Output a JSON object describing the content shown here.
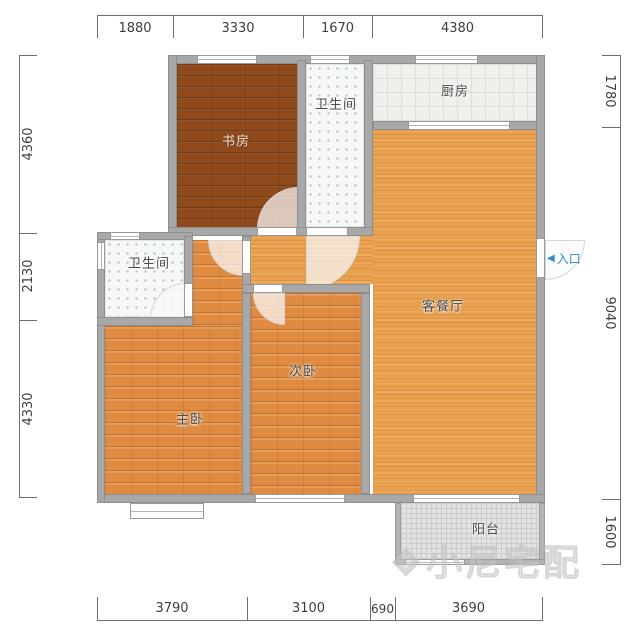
{
  "plan": {
    "rooms": [
      {
        "id": "study",
        "label": "书房"
      },
      {
        "id": "bathroom-top",
        "label": "卫生间"
      },
      {
        "id": "kitchen",
        "label": "厨房"
      },
      {
        "id": "living-dining",
        "label": "客餐厅"
      },
      {
        "id": "bathroom-2",
        "label": "卫生间"
      },
      {
        "id": "master-bedroom",
        "label": "主卧"
      },
      {
        "id": "second-bedroom",
        "label": "次卧"
      },
      {
        "id": "balcony",
        "label": "阳台"
      }
    ],
    "entrance": {
      "arrow": "◀",
      "label": "入口"
    },
    "watermark": {
      "logo": "◈",
      "text": "小尼宅配"
    }
  },
  "rulers": {
    "top": [
      "1880",
      "3330",
      "1670",
      "4380"
    ],
    "bottom": [
      "3790",
      "3100",
      "690",
      "3690"
    ],
    "left": [
      "4360",
      "2130",
      "4330"
    ],
    "right": [
      "1780",
      "9040",
      "1600"
    ]
  },
  "colors": {
    "entrance_accent": "#2f8ecb",
    "wall": "#a8a8a8",
    "study_floor": "#8f4a1c",
    "bedroom_floor": "#e08b42",
    "living_floor": "#e9a150",
    "dimension_text": "#3d3d3d"
  }
}
